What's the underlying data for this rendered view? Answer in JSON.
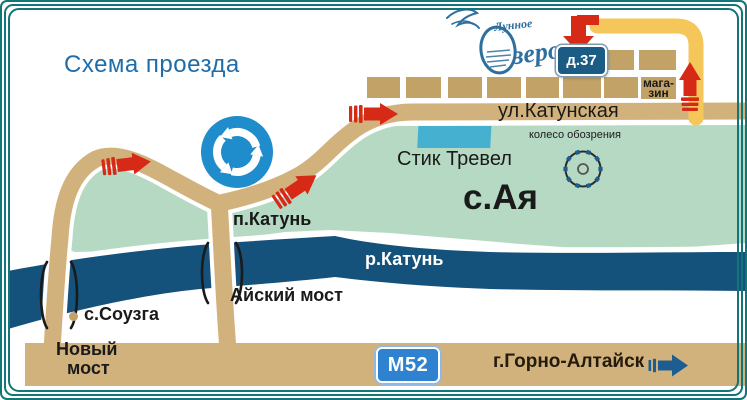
{
  "title": "Схема проезда",
  "logo": {
    "name": "Лунное Озеро",
    "word_top": "Лунное",
    "word_bottom": "зеро"
  },
  "signs": {
    "house_number": "д.37",
    "highway": "М52"
  },
  "labels": {
    "street": "ул.Катунская",
    "shop_line1": "мага-",
    "shop_line2": "зин",
    "stik_travel": "Стик Тревел",
    "ferris_wheel": "колесо обозрения",
    "village_aya": "с.Ая",
    "settlement_katun": "п.Катунь",
    "river_katun": "р.Катунь",
    "aysky_bridge": "Айский мост",
    "village_souzga": "с.Соузга",
    "new_bridge_line1": "Новый",
    "new_bridge_line2": "мост",
    "city_direction": "г.Горно-Алтайск"
  },
  "icons": {
    "roundabout_sign": "blue circle with three white circular arrows",
    "ferris_wheel": "circle with cabin dots",
    "route_arrows": "red striped direction arrows",
    "city_arrow": "dark blue right arrow",
    "bridge_marks": "black bracket strokes at river crossings",
    "logo_bird": "swan flourish sketch"
  },
  "colors": {
    "title_blue": "#1f6da8",
    "road_tan": "#d2b27c",
    "building_tan": "#c3a267",
    "area_green": "#b6d9c3",
    "river_blue": "#14527b",
    "roundabout_blue": "#1f8ccc",
    "arrow_red": "#d62a17",
    "yellow_road": "#f5c65a",
    "house_plate_blue": "#1a5c84",
    "m52_blue": "#2e82cf",
    "border_teal": "#127577",
    "city_arrow_blue": "#1d5d92",
    "stik_travel_cyan": "#46b0d0"
  }
}
